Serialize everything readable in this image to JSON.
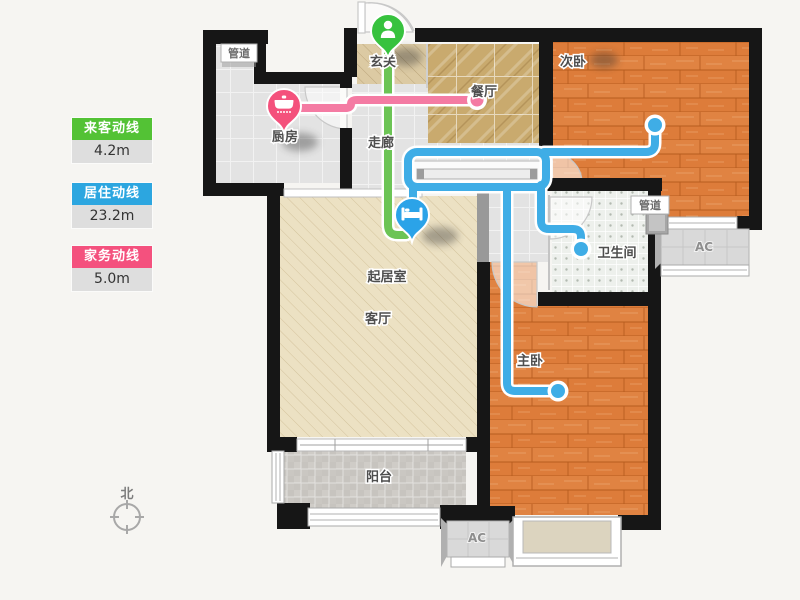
{
  "legend": {
    "items": [
      {
        "label": "来客动线",
        "value": "4.2m",
        "color": "#53c235"
      },
      {
        "label": "居住动线",
        "value": "23.2m",
        "color": "#2ca6e0"
      },
      {
        "label": "家务动线",
        "value": "5.0m",
        "color": "#f4517e"
      }
    ]
  },
  "compass": {
    "label": "北"
  },
  "rooms": {
    "kitchen": "厨房",
    "entrance": "玄关",
    "dining": "餐厅",
    "corridor": "走廊",
    "bedroom2": "次卧",
    "living": "起居室",
    "living2": "客厅",
    "bathroom": "卫生间",
    "master": "主卧",
    "balcony": "阳台",
    "duct_kitchen": "管道",
    "duct_bath": "管道",
    "ac_right": "AC",
    "ac_bottom": "AC"
  },
  "lines": {
    "guest": {
      "name": "来客动线",
      "color": "#6cc455"
    },
    "resident": {
      "name": "居住动线",
      "color": "#3fade6"
    },
    "chore": {
      "name": "家务动线",
      "color": "#f47ba3"
    }
  },
  "pins": {
    "entrance": {
      "icon": "person-icon",
      "color": "#37c23e"
    },
    "kitchen": {
      "icon": "pot-icon",
      "color": "#f4517c"
    },
    "living": {
      "icon": "bed-icon",
      "color": "#2ba3e8"
    }
  }
}
